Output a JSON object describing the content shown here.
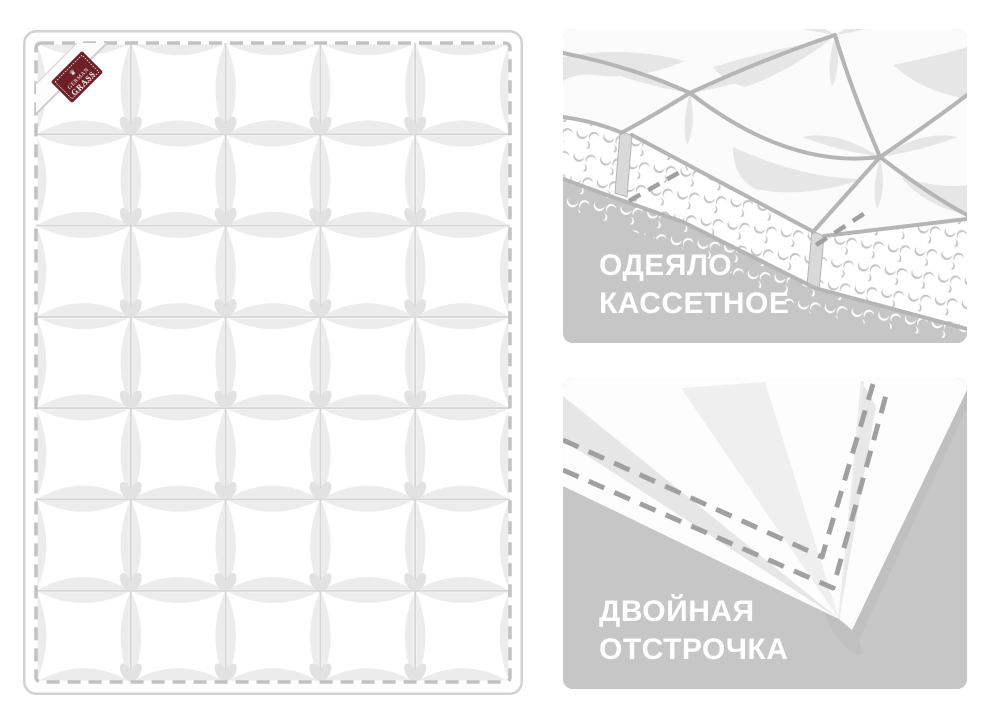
{
  "image_type": "product-feature-illustration",
  "quilt": {
    "grid": {
      "columns": 5,
      "rows": 7
    },
    "brand_label": {
      "line1": "GERMAN",
      "line2": "GRASS",
      "crown_icon": "crown"
    }
  },
  "panels": [
    {
      "id": "cassette",
      "label_line1": "ОДЕЯЛО",
      "label_line2": "КАССЕТНОЕ"
    },
    {
      "id": "double-stitch",
      "label_line1": "ДВОЙНАЯ",
      "label_line2": "ОТСТРОЧКА"
    }
  ],
  "colors": {
    "page_bg": "#ffffff",
    "panel_bg": "#c6c6c6",
    "caption_text": "#ffffff",
    "quilt_border": "#d2d2d2",
    "quilt_dash": "#c2c2c2",
    "seam": "#d6d6d6",
    "petal": "#ececec",
    "bud": "#e2e2e2",
    "art_seam": "#b5b5b5",
    "art_highlight": "#e6e6e6",
    "crescent": "#c5c5c5",
    "wall": "#d9d9d9",
    "stitch_dash": "#a0a0a0",
    "shadow": "#c0c0c0",
    "label_bg": "#6d2127",
    "label_text": "#ffffff"
  }
}
